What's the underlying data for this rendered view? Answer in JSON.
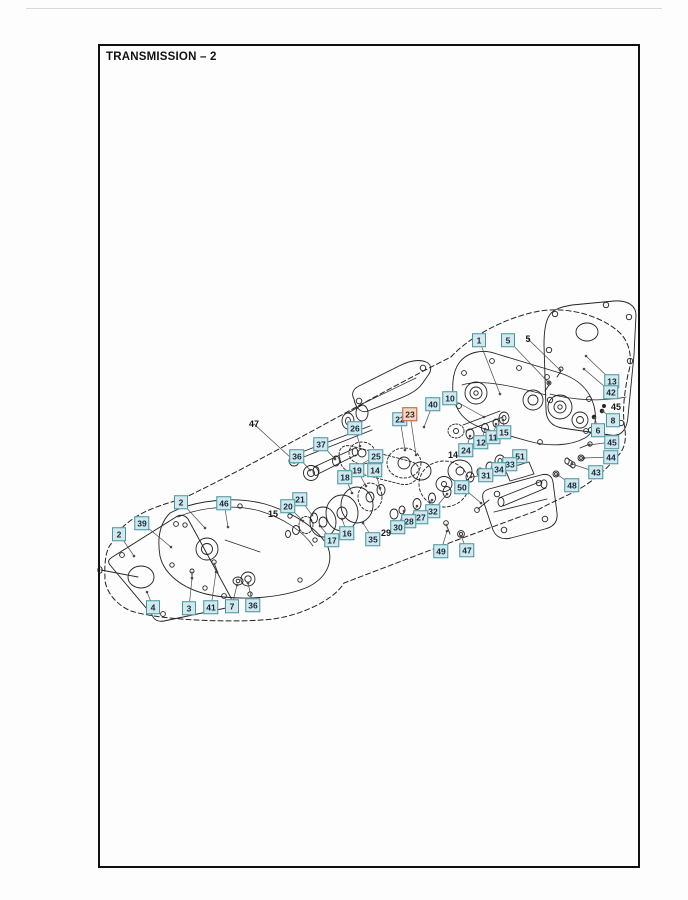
{
  "page": {
    "title": "TRANSMISSION – 2"
  },
  "colors": {
    "callout_bg": "#d3e8ec",
    "callout_border": "#4495a3",
    "callout_text": "#0e2b3d",
    "highlight_bg": "#f3d8c3",
    "highlight_border": "#c2582a",
    "highlight_text": "#3a2415",
    "plain_text": "#161616",
    "leader": "#4a4a4a",
    "line": "#222222"
  },
  "highlighted_item": "23",
  "diagram": {
    "callouts": [
      {
        "label": "1",
        "x": 479,
        "y": 340,
        "style": "box",
        "tx": 500,
        "ty": 394
      },
      {
        "label": "5",
        "x": 508,
        "y": 340,
        "style": "box",
        "tx": 549,
        "ty": 383
      },
      {
        "label": "13",
        "x": 612,
        "y": 381,
        "style": "box",
        "tx": 586,
        "ty": 356
      },
      {
        "label": "42",
        "x": 611,
        "y": 392,
        "style": "box",
        "tx": 584,
        "ty": 369
      },
      {
        "label": "8",
        "x": 613,
        "y": 420,
        "style": "box",
        "tx": 603,
        "ty": 411
      },
      {
        "label": "6",
        "x": 598,
        "y": 430,
        "style": "box",
        "tx": 595,
        "ty": 418
      },
      {
        "label": "45",
        "x": 612,
        "y": 442,
        "style": "box",
        "tx": 589,
        "ty": 445
      },
      {
        "label": "44",
        "x": 611,
        "y": 457,
        "style": "box",
        "tx": 584,
        "ty": 458
      },
      {
        "label": "43",
        "x": 596,
        "y": 472,
        "style": "box",
        "tx": 572,
        "ty": 464
      },
      {
        "label": "48",
        "x": 572,
        "y": 485,
        "style": "box",
        "tx": 558,
        "ty": 475
      },
      {
        "label": "10",
        "x": 450,
        "y": 398,
        "style": "box",
        "tx": 484,
        "ty": 417
      },
      {
        "label": "40",
        "x": 433,
        "y": 404,
        "style": "box",
        "tx": 424,
        "ty": 427
      },
      {
        "label": "22",
        "x": 400,
        "y": 419,
        "style": "box",
        "tx": 405,
        "ty": 450
      },
      {
        "label": "23",
        "x": 410,
        "y": 414,
        "style": "box",
        "highlight": true,
        "tx": 416,
        "ty": 455
      },
      {
        "label": "26",
        "x": 355,
        "y": 428,
        "style": "box",
        "tx": 360,
        "ty": 446
      },
      {
        "label": "37",
        "x": 321,
        "y": 444,
        "style": "box",
        "tx": 335,
        "ty": 459
      },
      {
        "label": "36",
        "x": 297,
        "y": 456,
        "style": "box",
        "tx": 310,
        "ty": 470
      },
      {
        "label": "25",
        "x": 376,
        "y": 456,
        "style": "box",
        "tx": 356,
        "ty": 467
      },
      {
        "label": "19",
        "x": 357,
        "y": 470,
        "style": "box",
        "tx": 366,
        "ty": 486
      },
      {
        "label": "14",
        "x": 375,
        "y": 470,
        "style": "box",
        "tx": 380,
        "ty": 488
      },
      {
        "label": "18",
        "x": 345,
        "y": 477,
        "style": "box",
        "tx": 352,
        "ty": 493
      },
      {
        "label": "24",
        "x": 466,
        "y": 450,
        "style": "box",
        "tx": 470,
        "ty": 436
      },
      {
        "label": "12",
        "x": 481,
        "y": 442,
        "style": "box",
        "tx": 485,
        "ty": 429
      },
      {
        "label": "11",
        "x": 493,
        "y": 437,
        "style": "box",
        "tx": 496,
        "ty": 424
      },
      {
        "label": "15",
        "x": 504,
        "y": 432,
        "style": "box",
        "tx": 503,
        "ty": 420
      },
      {
        "label": "51",
        "x": 520,
        "y": 456,
        "style": "box",
        "tx": 503,
        "ty": 461
      },
      {
        "label": "33",
        "x": 510,
        "y": 464,
        "style": "box",
        "tx": 492,
        "ty": 467
      },
      {
        "label": "34",
        "x": 499,
        "y": 469,
        "style": "box",
        "tx": 482,
        "ty": 472
      },
      {
        "label": "31",
        "x": 486,
        "y": 475,
        "style": "box",
        "tx": 471,
        "ty": 477
      },
      {
        "label": "50",
        "x": 462,
        "y": 487,
        "style": "box",
        "tx": 481,
        "ty": 503
      },
      {
        "label": "32",
        "x": 433,
        "y": 511,
        "style": "box",
        "tx": 447,
        "ty": 494
      },
      {
        "label": "27",
        "x": 421,
        "y": 517,
        "style": "box",
        "tx": 432,
        "ty": 500
      },
      {
        "label": "28",
        "x": 409,
        "y": 521,
        "style": "box",
        "tx": 417,
        "ty": 506
      },
      {
        "label": "30",
        "x": 398,
        "y": 527,
        "style": "box",
        "tx": 404,
        "ty": 511
      },
      {
        "label": "35",
        "x": 373,
        "y": 539,
        "style": "box",
        "tx": 363,
        "ty": 523
      },
      {
        "label": "16",
        "x": 347,
        "y": 533,
        "style": "box",
        "tx": 342,
        "ty": 519
      },
      {
        "label": "17",
        "x": 332,
        "y": 540,
        "style": "box",
        "tx": 320,
        "ty": 526
      },
      {
        "label": "21",
        "x": 300,
        "y": 499,
        "style": "box",
        "tx": 312,
        "ty": 515
      },
      {
        "label": "20",
        "x": 288,
        "y": 506,
        "style": "box",
        "tx": 303,
        "ty": 521
      },
      {
        "label": "49",
        "x": 441,
        "y": 551,
        "style": "box",
        "tx": 447,
        "ty": 531
      },
      {
        "label": "47",
        "x": 467,
        "y": 550,
        "style": "box",
        "tx": 461,
        "ty": 536
      },
      {
        "label": "2",
        "x": 181,
        "y": 502,
        "style": "box",
        "tx": 205,
        "ty": 528
      },
      {
        "label": "46",
        "x": 224,
        "y": 503,
        "style": "box",
        "tx": 228,
        "ty": 527
      },
      {
        "label": "39",
        "x": 142,
        "y": 523,
        "style": "box",
        "tx": 171,
        "ty": 547
      },
      {
        "label": "2",
        "x": 119,
        "y": 534,
        "style": "box",
        "tx": 134,
        "ty": 556
      },
      {
        "label": "4",
        "x": 153,
        "y": 607,
        "style": "box",
        "tx": 147,
        "ty": 592
      },
      {
        "label": "3",
        "x": 189,
        "y": 608,
        "style": "box",
        "tx": 192,
        "ty": 578
      },
      {
        "label": "41",
        "x": 211,
        "y": 607,
        "style": "box",
        "tx": 216,
        "ty": 572
      },
      {
        "label": "7",
        "x": 232,
        "y": 606,
        "style": "box",
        "tx": 237,
        "ty": 585
      },
      {
        "label": "36",
        "x": 253,
        "y": 605,
        "style": "box",
        "tx": 248,
        "ty": 583
      },
      {
        "label": "47",
        "x": 254,
        "y": 424,
        "style": "plain",
        "tx": 291,
        "ty": 458
      },
      {
        "label": "5",
        "x": 528,
        "y": 339,
        "style": "plain",
        "tx": 560,
        "ty": 370
      },
      {
        "label": "45",
        "x": 616,
        "y": 407,
        "style": "plain"
      },
      {
        "label": "14",
        "x": 453,
        "y": 455,
        "style": "plain"
      },
      {
        "label": "15",
        "x": 273,
        "y": 514,
        "style": "plain"
      },
      {
        "label": "29",
        "x": 386,
        "y": 533,
        "style": "plain"
      }
    ]
  }
}
